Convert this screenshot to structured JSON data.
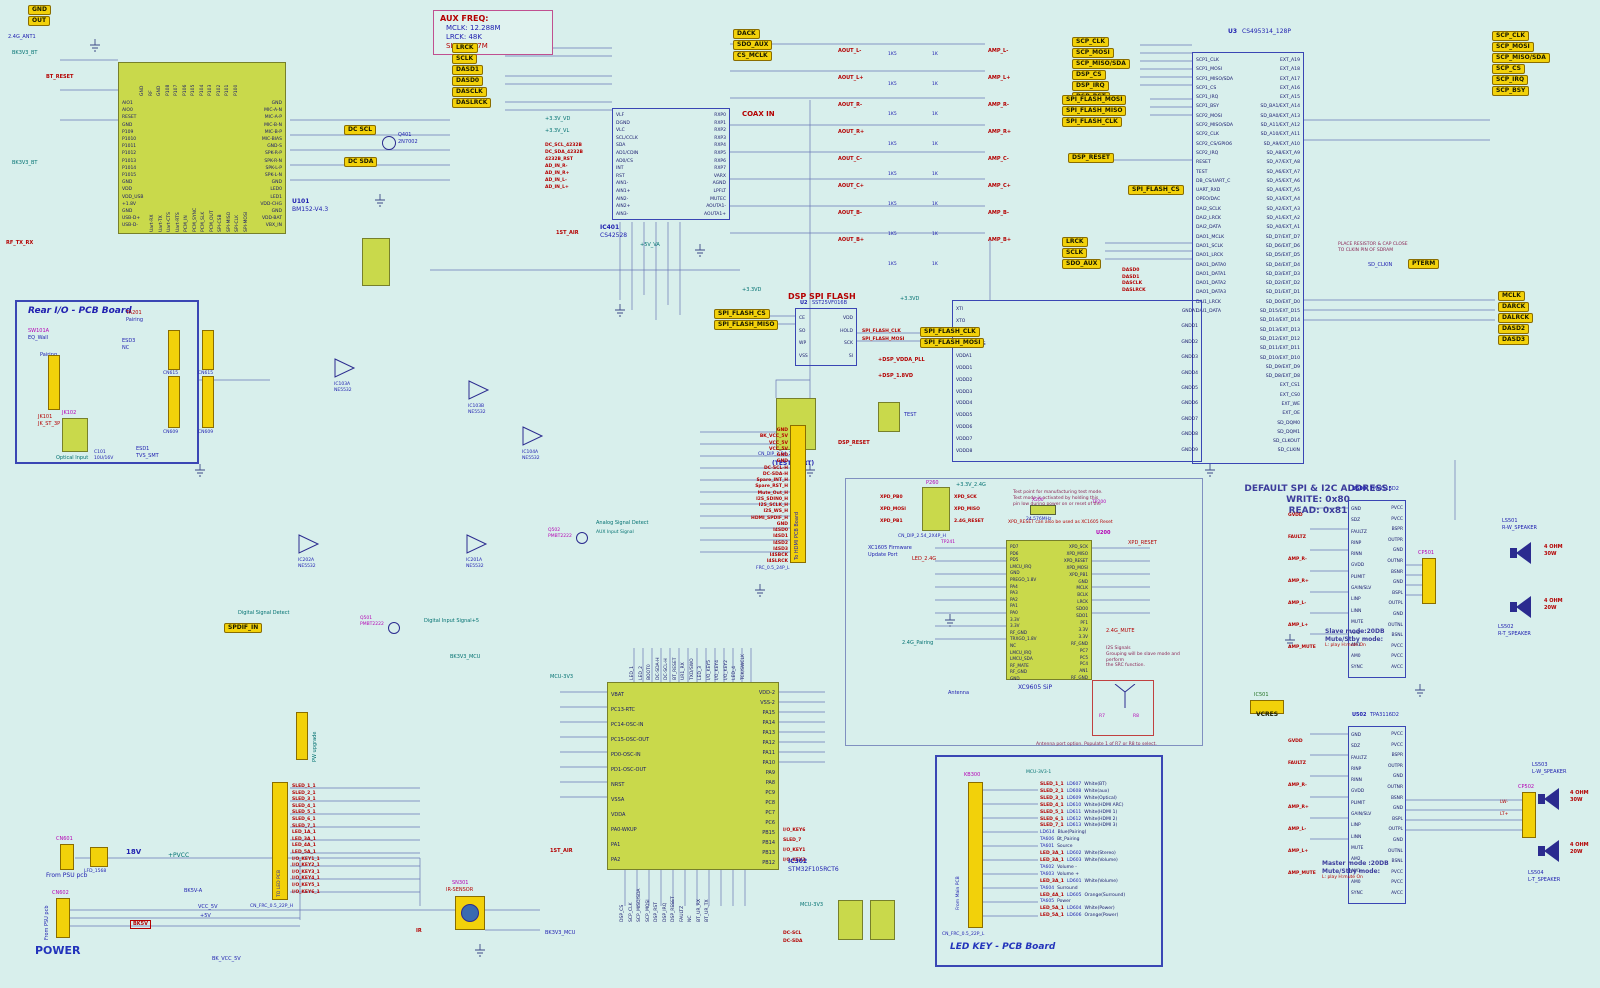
{
  "palette": {
    "bg": "#d8efec",
    "ic_fill": "#c9d94b",
    "tag_fill": "#f2d10a",
    "wire": "#6a78b5",
    "accent_blue": "#2020b0",
    "accent_red": "#b40000",
    "accent_magenta": "#b400b4",
    "accent_teal": "#007070",
    "board_border": "#3a46b4"
  },
  "notes": {
    "aux_freq": {
      "title": "AUX FREQ:",
      "l1": "MCLK: 12.288M",
      "l2": "LRCK: 48K",
      "l3": "SLCK:3.07M"
    },
    "addr": {
      "l1": "DEFAULT SPI & I2C ADDRESS:",
      "l2": "WRITE: 0x80",
      "l3": "READ: 0x81"
    },
    "slave": {
      "l1": "Slave mode:20DB",
      "l2": "Mute/Stby mode:",
      "l3": "L: play  H:mute On"
    },
    "master": {
      "l1": "Master mode :20DB",
      "l2": "Mute/Stby mode:",
      "l3": "L: play  H:mute On"
    },
    "mfg": {
      "l1": "Test point for manufacturing test mode.",
      "l2": "Test mode is activated by holding this",
      "l3": "pin low during power on or reset of the"
    },
    "xpd": "XPD_RESET can also be used as XC1605 Reset",
    "i2s": {
      "l1": "I2S Signals",
      "l2": "Grouping will be slave mode and perform",
      "l3": "the SRC function."
    },
    "antenna": "Antenna port option.  Populate 1 of R7 or R8 to select.",
    "fw_port": {
      "l1": "XC1605 Firmware",
      "l2": "Update Port"
    },
    "test_port": "(TEST PORT)",
    "sdram": "PLACE RESISTOR & CAP CLOSE TO CLKIN PIN OF SDRAM"
  },
  "tags": {
    "audio": [
      "LRCK",
      "SCLK",
      "DASD1",
      "DASD0",
      "DASCLK",
      "DASLRCK"
    ],
    "codec_top": [
      "DACK",
      "SDO_AUX",
      "CS_MCLK"
    ],
    "scp": [
      "SCP_CLK",
      "SCP_MOSI",
      "SCP_MISO/SDA",
      "DSP_CS",
      "DSP_IRQ",
      "DSP_RST"
    ],
    "scp2": [
      "SCP_CLK",
      "SCP_MOSI",
      "SCP_MISO/SDA",
      "SCP_CS",
      "SCP_IRQ",
      "SCP_BSY"
    ],
    "flash": [
      "SPI_FLASH_MOSI",
      "SPI_FLASH_MISO",
      "SPI_FLASH_CLK"
    ],
    "flash_l": [
      "SPI_FLASH_CS",
      "SPI_FLASH_MISO"
    ],
    "flash_r": [
      "SPI_FLASH_CLK",
      "SPI_FLASH_MOSI"
    ],
    "flash_cs": "SPI_FLASH_CS",
    "dsp_reset": "DSP_RESET",
    "audio2": [
      "LRCK",
      "SCLK",
      "SDO_AUX"
    ],
    "dao": [
      "MCLK",
      "DARCK",
      "DALRCK",
      "DASD2",
      "DASD3"
    ],
    "pterm": "PTERM",
    "dcscl": "DC SCL",
    "dcsda": "DC SDA",
    "spdif": "SPDIF_IN",
    "gnd": "GND",
    "out": "OUT",
    "bk5v": "BK5V"
  },
  "bt": {
    "ref": "U101",
    "part": "BM152-V4.3",
    "left": [
      "AIO1",
      "AIO0",
      "RESET",
      "GND",
      "P109",
      "P1010",
      "P1011",
      "P1012",
      "P1013",
      "P1014",
      "P1015",
      "GND",
      "VDD",
      "VDD_USB",
      "+1.8V",
      "GND",
      "USB-D+",
      "USB-D-"
    ],
    "right": [
      "GND",
      "MIC-A-N",
      "MIC-A-P",
      "MIC-B-N",
      "MIC-B-P",
      "MIC-BIAS",
      "GND-S",
      "SPK-R-P",
      "SPK-R-N",
      "SPK-L-P",
      "SPK-L-N",
      "GND",
      "LED0",
      "LED1",
      "VDD-CHG",
      "GND",
      "VDD-BAT",
      "VBX_IN"
    ],
    "top": [
      "GND",
      "RF",
      "GND",
      "P108",
      "P107",
      "P106",
      "P105",
      "P104",
      "P103",
      "P102",
      "P101",
      "P100"
    ],
    "bottom": [
      "Uart-RX",
      "Uart-TX",
      "Uart-CTS",
      "Uart-RTS",
      "PCM_IN",
      "PCM_SYNC",
      "PCM_SLK",
      "PCM_OUT",
      "SPI-CSB",
      "SPI-MISO",
      "SPI-CLK",
      "SPI-MOSI"
    ],
    "ant": "2.4G_ANT1",
    "bk": "BK3V3_BT",
    "reset": "BT_RESET",
    "rftx": "RF_TX_RX"
  },
  "codec": {
    "ref": "IC401",
    "part": "CS42528",
    "coax": "COAX IN",
    "va": "+5V_VA",
    "left": [
      "VLF",
      "DGND",
      "VLC",
      "SCL/CCLK",
      "SDA",
      "AD1/CDIN",
      "AD0/CS",
      "INT",
      "RST",
      "AIN1-",
      "AIN1+",
      "AIN2-",
      "AIN2+",
      "AIN3-"
    ],
    "right": [
      "RXP0",
      "RXP1",
      "RXP2",
      "RXP3",
      "RXP4",
      "RXP5",
      "RXP6",
      "RXP7",
      "VARX",
      "AGND",
      "LPFLT",
      "MUTEC",
      "AOUTA1-",
      "AOUTA1+"
    ],
    "nets": [
      "+3.3V_VD",
      "+3.3V_VL"
    ],
    "nets2": [
      "DC_SCL_4232B",
      "DC_SDA_4232B",
      "4232B_RST",
      "AD_IN_R-",
      "AD_IN_R+",
      "AD_IN_L-",
      "AD_IN_L+"
    ]
  },
  "bank": {
    "a": [
      "AOUT_L-",
      "AOUT_L+",
      "AOUT_R-",
      "AOUT_R+",
      "AOUT_C-",
      "AOUT_C+",
      "AOUT_B-",
      "AOUT_B+"
    ],
    "r1": [
      "1K5",
      "1K5",
      "1K5",
      "1K5",
      "1K5",
      "1K5",
      "1K5",
      "1K5"
    ],
    "r2": [
      "1K",
      "1K",
      "1K",
      "1K",
      "1K",
      "1K",
      "1K",
      "1K"
    ],
    "b": [
      "AMP_L-",
      "AMP_L+",
      "AMP_R-",
      "AMP_R+",
      "AMP_C-",
      "AMP_C+",
      "AMP_B-",
      "AMP_B+"
    ]
  },
  "dsp": {
    "ref": "U3",
    "part": "CS495314_128P",
    "sd_clkin": "SD_CLKIN",
    "bus": [
      "DASD0",
      "DASD1",
      "DASCLK",
      "DASLRCK"
    ],
    "left": [
      "SCP1_CLK",
      "SCP1_MOSI",
      "SCP1_MISO/SDA",
      "SCP1_CS",
      "SCP1_IRQ",
      "SCP1_BSY",
      "SCP2_MOSI",
      "SCP2_MISO/SDA",
      "SCP2_CLK",
      "SCP2_CS/GPIO6",
      "SCP2_IRQ",
      "RESET",
      "TEST",
      "DB_CS/UART_C",
      "UART_RXD",
      "OPEO/DAC",
      "DAI2_SCLK",
      "DAI2_LRCK",
      "DAI2_DATA",
      "DAO1_MCLK",
      "DAO1_SCLK",
      "DAO1_LRCK",
      "DAO1_DATA0",
      "DAO1_DATA1",
      "DAO1_DATA2",
      "DAO1_DATA3",
      "DAI1_LRCK",
      "DAI1_DATA"
    ],
    "right": [
      "EXT_A19",
      "EXT_A18",
      "EXT_A17",
      "EXT_A16",
      "EXT_A15",
      "SD_BA1/EXT_A14",
      "SD_BA0/EXT_A13",
      "SD_A11/EXT_A12",
      "SD_A10/EXT_A11",
      "SD_A9/EXT_A10",
      "SD_A8/EXT_A9",
      "SD_A7/EXT_A8",
      "SD_A6/EXT_A7",
      "SD_A5/EXT_A6",
      "SD_A4/EXT_A5",
      "SD_A3/EXT_A4",
      "SD_A2/EXT_A3",
      "SD_A1/EXT_A2",
      "SD_A0/EXT_A1",
      "SD_D7/EXT_D7",
      "SD_D6/EXT_D6",
      "SD_D5/EXT_D5",
      "SD_D4/EXT_D4",
      "SD_D3/EXT_D3",
      "SD_D2/EXT_D2",
      "SD_D1/EXT_D1",
      "SD_D0/EXT_D0",
      "SD_D15/EXT_D15",
      "SD_D14/EXT_D14",
      "SD_D13/EXT_D13",
      "SD_D12/EXT_D12",
      "SD_D11/EXT_D11",
      "SD_D10/EXT_D10",
      "SD_D9/EXT_D9",
      "SD_D8/EXT_D8",
      "EXT_CS1",
      "EXT_CS0",
      "EXT_WE",
      "EXT_OE",
      "SD_DQM0",
      "SD_DQM1",
      "SD_CLKOUT",
      "SD_CLKIN"
    ],
    "pwr_left": [
      "+DSP_VDDA_PLL",
      "+DSP_1.8VD"
    ],
    "pwr_box_l": [
      "XTI",
      "XTO",
      "PLL_FILT",
      "PLL_REF_RES",
      "VDDA1",
      "VDDD1",
      "VDDD2",
      "VDDD3",
      "VDDD4",
      "VDDD5",
      "VDDD6",
      "VDDD7",
      "VDDD8"
    ],
    "pwr_box_r": [
      "GNDA1",
      "GNDD1",
      "GNDD2",
      "GNDD3",
      "GNDD4",
      "GNDD5",
      "GNDD6",
      "GNDD7",
      "GNDD8",
      "GNDD9"
    ]
  },
  "flash": {
    "title": "DSP SPI FLASH",
    "ref": "U2",
    "part": "SST25VF016B",
    "left": [
      "CE",
      "SO",
      "WP",
      "VSS"
    ],
    "right": [
      "VDD",
      "HOLD",
      "SCK",
      "SI"
    ],
    "conn": "CN_DIP_2.54_2X4P_H",
    "test": "TEST",
    "pwr": "+3.3VD"
  },
  "rear": {
    "title": "Rear I/O - PCB Board",
    "sw_ref": "SW101A",
    "sw": "EQ_Wall",
    "pair": "Pairing",
    "ta": "TA201",
    "jack_ref": "JK101",
    "jack": "JK_ST_3P",
    "opt_ref": "JK102",
    "opt": "Optical Input",
    "esd3": "ESD3",
    "esd3v": "NC",
    "esd1": "ESD1",
    "esd1v": "TVS_SMT",
    "c101": "C101",
    "c101v": "10U/16V",
    "cn615": "CN615",
    "cn609": "CN609"
  },
  "opamps": [
    {
      "ref": "IC103A",
      "part": "NE5532"
    },
    {
      "ref": "IC103B",
      "part": "NE5532"
    },
    {
      "ref": "IC104A",
      "part": "NE5532"
    },
    {
      "ref": "IC201A",
      "part": "NE5532"
    },
    {
      "ref": "IC202A",
      "part": "NE5532"
    }
  ],
  "detect": {
    "analog": "Analog Signal Detect",
    "aux": "AUX Input Signal",
    "digital": "Digital Signal Detect",
    "dig_in": "Digital Input Signal+5",
    "q501": "Q501",
    "q502": "Q502",
    "pmbt": "PMBT2222"
  },
  "hdmi": {
    "label": "To HDMI PCB Board",
    "conn": "FRC_0.5_24P_L",
    "signals": [
      "GND",
      "BK_VCC_5V",
      "VCC_5V",
      "VCC_5V",
      "GND",
      "GND",
      "DC-SCL-H",
      "DC-SDA-H",
      "Spare_INT_H",
      "Spare_RST_H",
      "Mute_Out_H",
      "I2S_SDIN0_H",
      "I2S_SCLK_H",
      "I2S_WS_H",
      "HDMI_SPDIF_H",
      "GND",
      "I4SD0",
      "I4SD1",
      "I4SD2",
      "I4SD3",
      "I4SBCK",
      "I4SLRCK"
    ]
  },
  "rf": {
    "ref": "U200",
    "part": "XC9605 SiP",
    "p260": "P260",
    "p260_conn": "CN_DIP_2.54_2X4P_H",
    "p260_l": [
      "XPD_PB0",
      "XPD_MOSI",
      "XPD_PB1"
    ],
    "p260_r": [
      "XPD_SCK",
      "XPD_MISO",
      "2.4G_RESET"
    ],
    "x200": "X200",
    "xfreq": "24.576MHz",
    "tp200": "TP200",
    "tp241": "TP241",
    "left": [
      "PD7",
      "PD6",
      "PD5",
      "LMCU_IRQ",
      "GND",
      "PREGO_1.8V",
      "PA4",
      "PA3",
      "PA2",
      "PA1",
      "PA0",
      "3.3V",
      "3.3V",
      "RF_GND",
      "TRXGO_1.8V",
      "NC",
      "LMCU_IRQ",
      "LMCU_SDA",
      "RF_MATE",
      "RF_GND",
      "GND"
    ],
    "right": [
      "XPD_SCK",
      "XPD_MISO",
      "XPD_RESET",
      "XPD_MOSI",
      "XPD_PB1",
      "GND",
      "MCLK",
      "BCLK",
      "LRCK",
      "SDO0",
      "SDO1",
      "PF1",
      "3.3V",
      "3.3V",
      "RF_GND",
      "PC7",
      "PC5",
      "PC4",
      "AN1",
      "RF_GND"
    ],
    "nets": [
      "LED_2.4G",
      "2.4G_Pairing",
      "+3.3V_2.4G"
    ],
    "mute": "2.4G_MUTE",
    "xpd_reset": "XPD_RESET",
    "antenna": "Antenna",
    "r7": "R7",
    "r8": "R8"
  },
  "mcu": {
    "ref": "IC302",
    "part": "STM32F105RCT6",
    "bk": "BK3V3_MCU",
    "v33": "MCU-3V3",
    "air": "1ST_AIR",
    "left": [
      "VBAT",
      "PC13-RTC",
      "PC14-OSC-IN",
      "PC15-OSC-OUT",
      "PD0-OSC-IN",
      "PD1-OSC-OUT",
      "NRST",
      "VSSA",
      "VDDA",
      "PA0-WKUP",
      "PA1",
      "PA2"
    ],
    "right": [
      "VDD-2",
      "VSS-2",
      "PA15",
      "PA14",
      "PA13",
      "PA12",
      "PA11",
      "PA10",
      "PA9",
      "PA8",
      "PC9",
      "PC8",
      "PC7",
      "PC6",
      "PB15",
      "PB14",
      "PB13",
      "PB12"
    ],
    "keys": [
      "I/O_KEY6",
      "SLED_7",
      "I/O_KEY1",
      "I/O_KEY3"
    ],
    "top": [
      "LED_1",
      "LED_2",
      "BOOT0",
      "DC-SDA-H",
      "DC-SCL-H",
      "BT_RESET",
      "UR1_RX",
      "TXD/SWO",
      "LED_3",
      "I/O_KEY5",
      "I/O_KEY4",
      "I/O_KEY2",
      "LED_4",
      "TCK/SWCLK"
    ],
    "bottom": [
      "DSP_CS",
      "SCP_CLK",
      "SCP_MISO/SDA",
      "SCP_MOSI",
      "DSP_RST",
      "DSP_IRQ",
      "DSP_RESET",
      "FAULTZ",
      "NC",
      "BT_UR_RX",
      "BT_UR_TX"
    ],
    "dc": [
      "DC-SCL",
      "DC-SDA"
    ]
  },
  "amp": {
    "part": "TPA3116D2",
    "ref1": "U500",
    "ref2": "U502",
    "ic501": "IC501",
    "vcres": "VCRES",
    "left": [
      "GND",
      "SDZ",
      "FAULTZ",
      "RINP",
      "RINN",
      "GVDD",
      "PLIMIT",
      "GAIN/SLV",
      "LINP",
      "LINN",
      "MUTE",
      "AM2",
      "AM1",
      "AM0",
      "SYNC"
    ],
    "right": [
      "PVCC",
      "PVCC",
      "BSPR",
      "OUTPR",
      "GND",
      "OUTNR",
      "BSNR",
      "GND",
      "BSPL",
      "OUTPL",
      "GND",
      "OUTNL",
      "BSNL",
      "PVCC",
      "PVCC",
      "AVCC"
    ],
    "nets": [
      "GVDD",
      "FAULTZ",
      "AMP_R-",
      "AMP_R+",
      "AMP_L-",
      "AMP_L+",
      "AMP_MUTE"
    ]
  },
  "speakers": {
    "cp1": "CP501",
    "cp2": "CP502",
    "lw": "LW-",
    "lt": "LT+",
    "list": [
      {
        "ref": "LS501",
        "name": "R-W_SPEAKER",
        "ohm": "4 OHM",
        "w": "30W"
      },
      {
        "ref": "LS502",
        "name": "R-T_SPEAKER",
        "ohm": "4 OHM",
        "w": "20W"
      },
      {
        "ref": "LS503",
        "name": "L-W_SPEAKER",
        "ohm": "4 OHM",
        "w": "30W"
      },
      {
        "ref": "LS504",
        "name": "L-T_SPEAKER",
        "ohm": "4 OHM",
        "w": "20W"
      }
    ]
  },
  "power": {
    "title": "POWER",
    "v18": "18V",
    "l3": "LFD_1568",
    "cn601": "CN601",
    "cn602": "CN602",
    "psu": "From PSU pcb",
    "pvcc": "+PVCC",
    "bk5va": "BK5V-A",
    "vcc5": "VCC_5V",
    "p5": "+5V",
    "bkvcc": "BK_VCC_5V"
  },
  "ir": {
    "ref": "SN301",
    "part": "IR-SENSOR",
    "net": "BK3V3_MCU",
    "sig": "IR"
  },
  "ledconn": {
    "conn": "CN_FRC_0.5_22P_H",
    "label": "TO LED PCB",
    "signals": [
      "SLED_1_1",
      "SLED_2_1",
      "SLED_3_1",
      "SLED_4_1",
      "SLED_5_1",
      "SLED_6_1",
      "SLED_7_1",
      "LED_1A_1",
      "LED_3A_1",
      "LED_4A_1",
      "LED_5A_1",
      "I/O_KEY1_1",
      "I/O_KEY2_1",
      "I/O_KEY3_1",
      "I/O_KEY4_1",
      "I/O_KEY5_1",
      "I/O_KEY6_1"
    ]
  },
  "pw_upgrade": "PW upgrade",
  "q401": {
    "ref": "Q401",
    "part": "2N7002"
  },
  "ledkey": {
    "title": "LED KEY - PCB Board",
    "kb": "KB300",
    "from": "From Main PCB",
    "conn": "CN_FRC_0.5_22P_L",
    "v33": "MCU-3V3-1",
    "rows": [
      {
        "net": "SLED_1_1",
        "ld": "LD607",
        "label": "White(BT)"
      },
      {
        "net": "SLED_2_1",
        "ld": "LD608",
        "label": "White(aux)"
      },
      {
        "net": "SLED_3_1",
        "ld": "LD609",
        "label": "White(Optical)"
      },
      {
        "net": "SLED_4_1",
        "ld": "LD610",
        "label": "White(HDMI ARC)"
      },
      {
        "net": "SLED_5_1",
        "ld": "LD611",
        "label": "White(HDMI 1)"
      },
      {
        "net": "SLED_6_1",
        "ld": "LD612",
        "label": "White(HDMI 2)"
      },
      {
        "net": "SLED_7_1",
        "ld": "LD613",
        "label": "White(HDMI 3)"
      },
      {
        "ld": "LD614",
        "label": "Blue(Pairing)"
      },
      {
        "ref": "TA606",
        "label": "Bt_Pairing"
      },
      {
        "ref": "TA601",
        "label": "Source"
      },
      {
        "net": "LED_3A_1",
        "ld": "LD602",
        "label": "White(Stereo)"
      },
      {
        "net": "LED_3A_1",
        "ld": "LD603",
        "label": "White(Volume)"
      },
      {
        "ref": "TA602",
        "label": "Volume -"
      },
      {
        "ref": "TA603",
        "label": "Volume +"
      },
      {
        "net": "LED_3A_1",
        "ld": "LD601",
        "label": "White(Volume)"
      },
      {
        "ref": "TA604",
        "label": "Surround"
      },
      {
        "net": "LED_4A_1",
        "ld": "LD605",
        "label": "Orange(Surround)"
      },
      {
        "ref": "TA605",
        "label": "Power"
      },
      {
        "net": "LED_5A_1",
        "ld": "LD604",
        "label": "White(Power)"
      },
      {
        "net": "LED_5A_1",
        "ld": "LD606",
        "label": "Orange(Power)"
      }
    ]
  }
}
